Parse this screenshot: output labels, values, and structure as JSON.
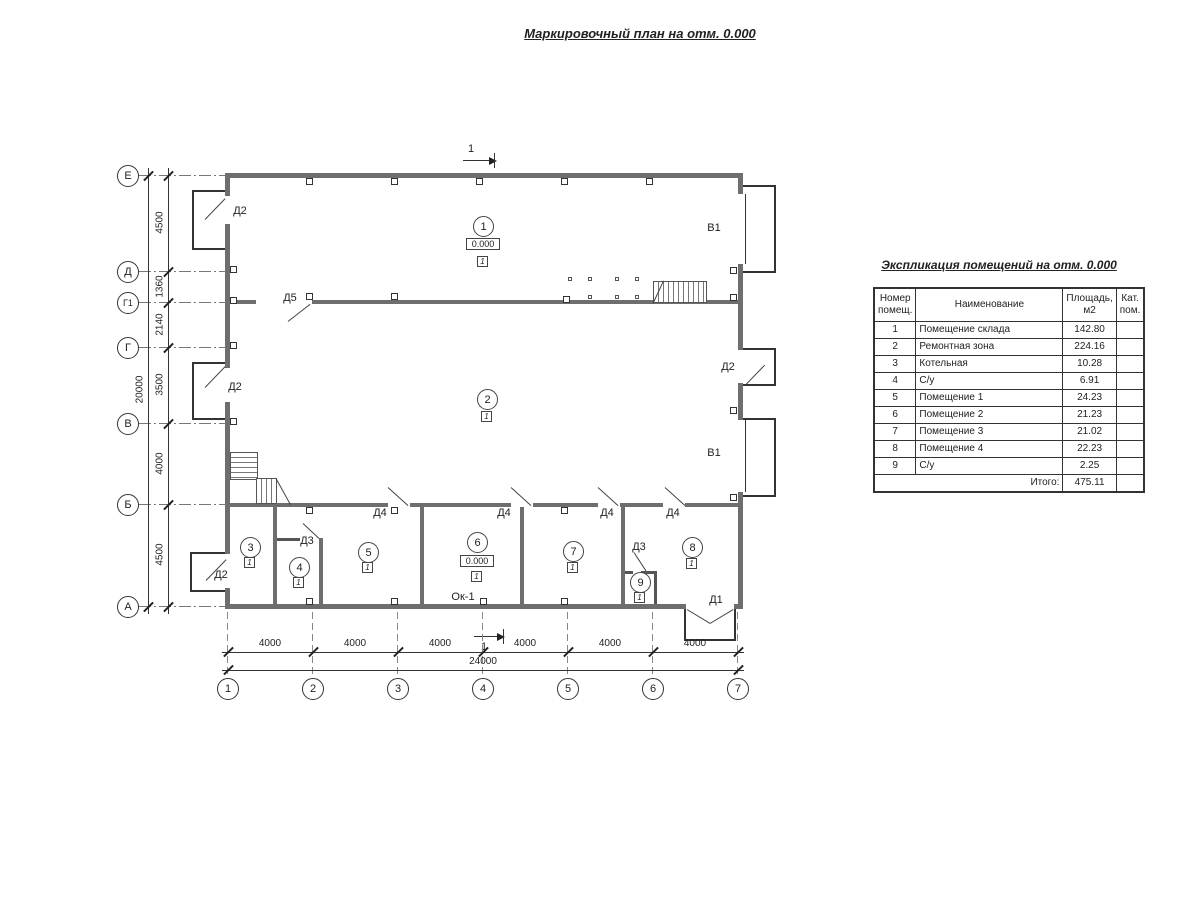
{
  "title": "Маркировочный план на отм. 0.000",
  "section_label": "1",
  "axes": {
    "left": [
      "Е",
      "Д",
      "Г1",
      "Г",
      "В",
      "Б",
      "А"
    ],
    "bottom": [
      "1",
      "2",
      "3",
      "4",
      "5",
      "6",
      "7"
    ]
  },
  "dims": {
    "left_segments": [
      "4500",
      "1360",
      "2140",
      "3500",
      "4000",
      "4500"
    ],
    "left_total": "20000",
    "bottom_segment": "4000",
    "bottom_total": "24000"
  },
  "labels": {
    "d1": "Д1",
    "d2": "Д2",
    "d3": "Д3",
    "d4": "Д4",
    "d5": "Д5",
    "v1": "В1",
    "ok1": "Ок-1",
    "level": "0.000",
    "cat": "1"
  },
  "rooms": [
    "1",
    "2",
    "3",
    "4",
    "5",
    "6",
    "7",
    "8",
    "9"
  ],
  "table": {
    "title": "Экспликация помещений на отм. 0.000",
    "headers": {
      "num": "Номер помещ.",
      "name": "Наименование",
      "area": "Площадь, м2",
      "cat": "Кат. пом."
    },
    "rows": [
      {
        "num": "1",
        "name": "Помещение склада",
        "area": "142.80"
      },
      {
        "num": "2",
        "name": "Ремонтная зона",
        "area": "224.16"
      },
      {
        "num": "3",
        "name": "Котельная",
        "area": "10.28"
      },
      {
        "num": "4",
        "name": "С/у",
        "area": "6.91"
      },
      {
        "num": "5",
        "name": "Помещение 1",
        "area": "24.23"
      },
      {
        "num": "6",
        "name": "Помещение 2",
        "area": "21.23"
      },
      {
        "num": "7",
        "name": "Помещение 3",
        "area": "21.02"
      },
      {
        "num": "8",
        "name": "Помещение 4",
        "area": "22.23"
      },
      {
        "num": "9",
        "name": "С/у",
        "area": "2.25"
      }
    ],
    "total_label": "Итого:",
    "total": "475.11"
  }
}
